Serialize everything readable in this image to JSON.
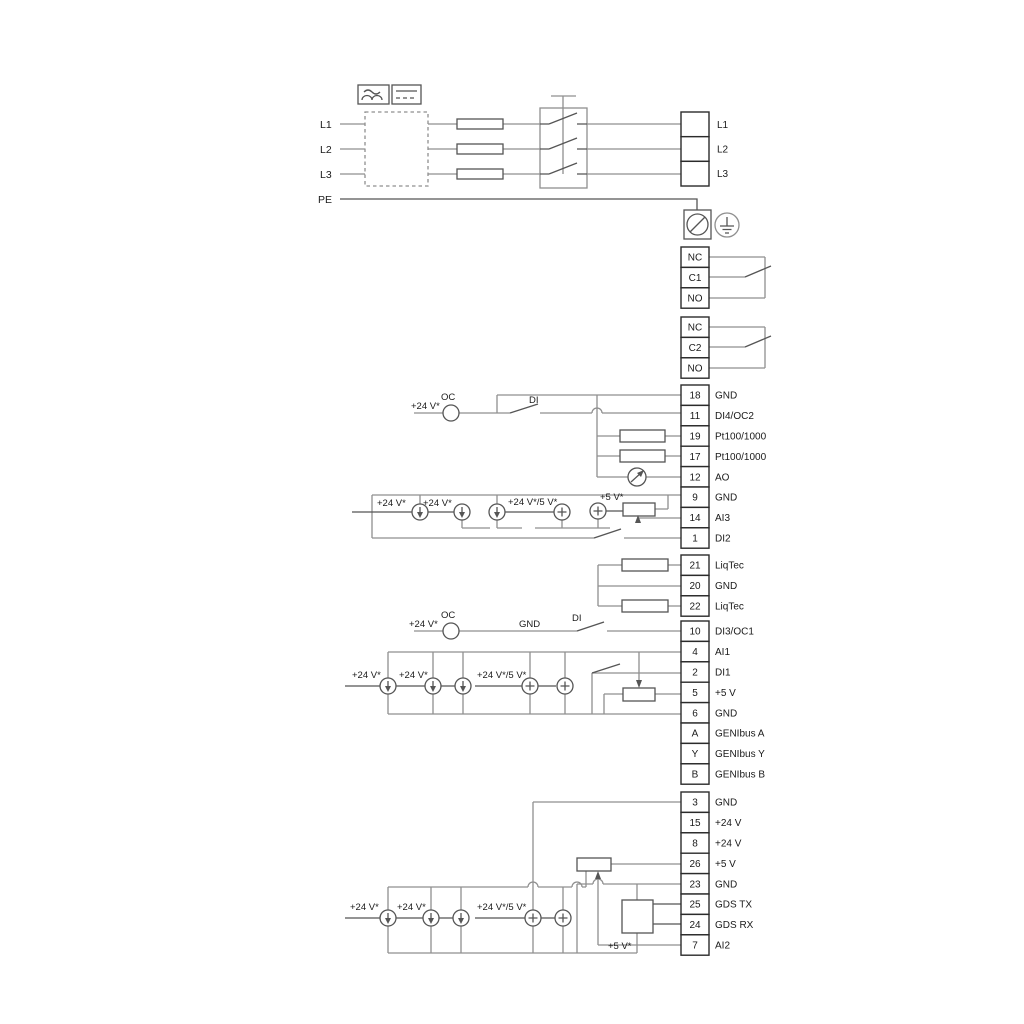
{
  "power_in": {
    "l1": "L1",
    "l2": "L2",
    "l3": "L3",
    "pe": "PE"
  },
  "blocks": {
    "mains": {
      "mode": "label",
      "rows": [
        "L1",
        "L2",
        "L3"
      ]
    },
    "relay1": {
      "mode": "cell",
      "rows": [
        "NC",
        "C1",
        "NO"
      ]
    },
    "relay2": {
      "mode": "cell",
      "rows": [
        "NC",
        "C2",
        "NO"
      ]
    },
    "io1": {
      "mode": "pair",
      "rows": [
        [
          "18",
          "GND"
        ],
        [
          "11",
          "DI4/OC2"
        ],
        [
          "19",
          "Pt100/1000"
        ],
        [
          "17",
          "Pt100/1000"
        ],
        [
          "12",
          "AO"
        ],
        [
          "9",
          "GND"
        ],
        [
          "14",
          "AI3"
        ],
        [
          "1",
          "DI2"
        ]
      ]
    },
    "liqtec": {
      "mode": "pair",
      "rows": [
        [
          "21",
          "LiqTec"
        ],
        [
          "20",
          "GND"
        ],
        [
          "22",
          "LiqTec"
        ]
      ]
    },
    "io2": {
      "mode": "pair",
      "rows": [
        [
          "10",
          "DI3/OC1"
        ],
        [
          "4",
          "AI1"
        ],
        [
          "2",
          "DI1"
        ],
        [
          "5",
          "+5 V"
        ],
        [
          "6",
          "GND"
        ],
        [
          "A",
          "GENIbus A"
        ],
        [
          "Y",
          "GENIbus Y"
        ],
        [
          "B",
          "GENIbus B"
        ]
      ]
    },
    "io3": {
      "mode": "pair",
      "rows": [
        [
          "3",
          "GND"
        ],
        [
          "15",
          "+24 V"
        ],
        [
          "8",
          "+24 V"
        ],
        [
          "26",
          "+5 V"
        ],
        [
          "23",
          "GND"
        ],
        [
          "25",
          "GDS TX"
        ],
        [
          "24",
          "GDS RX"
        ],
        [
          "7",
          "AI2"
        ]
      ]
    }
  },
  "wire_labels": {
    "v24": "+24 V*",
    "v24_5": "+24 V*/5 V*",
    "v5": "+5 V*",
    "oc": "OC",
    "di": "DI",
    "gnd": "GND"
  },
  "colors": {
    "wire": "#8f8f8f",
    "component": "#555555",
    "terminal": "#2b2b2b",
    "text": "#1a1a1a"
  }
}
